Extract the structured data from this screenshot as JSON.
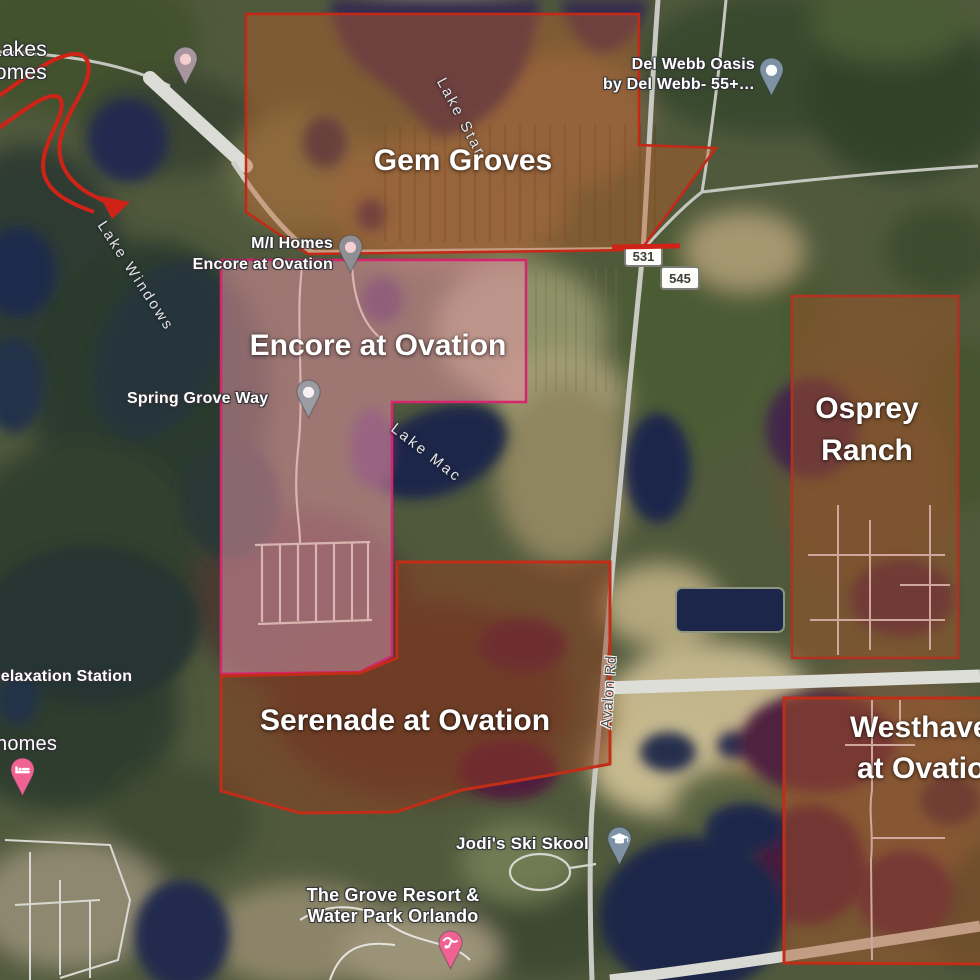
{
  "communities": [
    {
      "name": "Gem Groves",
      "border_color": "#c62817",
      "fill_color": "rgba(190,95,40,0.42)"
    },
    {
      "name": "Encore at Ovation",
      "border_color": "#d6246e",
      "fill_color": "rgba(235,150,170,0.50)"
    },
    {
      "name": "Serenade at Ovation",
      "border_color": "#c22d18",
      "fill_color": "rgba(150,62,30,0.46)"
    },
    {
      "name": "Osprey Ranch",
      "lines": [
        "Osprey",
        "Ranch"
      ],
      "border_color": "#b5301f",
      "fill_color": "rgba(165,82,38,0.46)"
    },
    {
      "name": "Westhaven at Ovation",
      "lines": [
        "Westhaven",
        "at Ovation"
      ],
      "border_color": "#c22d18",
      "fill_color": "rgba(170,86,40,0.46)"
    }
  ],
  "pois": [
    {
      "id": "lakes-homes",
      "lines": [
        "Lakes",
        "omes"
      ]
    },
    {
      "id": "del-webb",
      "lines": [
        "Del Webb Oasis",
        "by Del Webb- 55+…"
      ]
    },
    {
      "id": "mi-homes",
      "lines": [
        "M/I Homes",
        "Encore at Ovation"
      ]
    },
    {
      "id": "spring-grove-way",
      "label": "Spring Grove Way"
    },
    {
      "id": "relaxation-station",
      "label": "Relaxation Station"
    },
    {
      "id": "homes",
      "label": "homes"
    },
    {
      "id": "jodis-ski-skool",
      "label": "Jodi's Ski Skool"
    },
    {
      "id": "grove-resort",
      "lines": [
        "The Grove Resort &",
        "Water Park Orlando"
      ]
    }
  ],
  "water_labels": [
    {
      "label": "Lake Star"
    },
    {
      "label": "Lake Windows"
    },
    {
      "label": "Lake Mac"
    }
  ],
  "roads": {
    "avalon_label": "Avalon Rd",
    "shield_main": "545",
    "shield_partial": "531"
  },
  "pins": [
    {
      "type": "builder-pin",
      "color": "#a8969e"
    },
    {
      "type": "del-webb-pin",
      "color": "#7d93a3"
    },
    {
      "type": "mi-homes-pin",
      "color": "#8f8f93"
    },
    {
      "type": "spring-grove-pin",
      "color": "#9b9ba3"
    },
    {
      "type": "hotel-pin",
      "color": "#f06292"
    },
    {
      "type": "school-pin",
      "color": "#7d93a3"
    },
    {
      "type": "waterpark-pin",
      "color": "#f06292"
    }
  ]
}
